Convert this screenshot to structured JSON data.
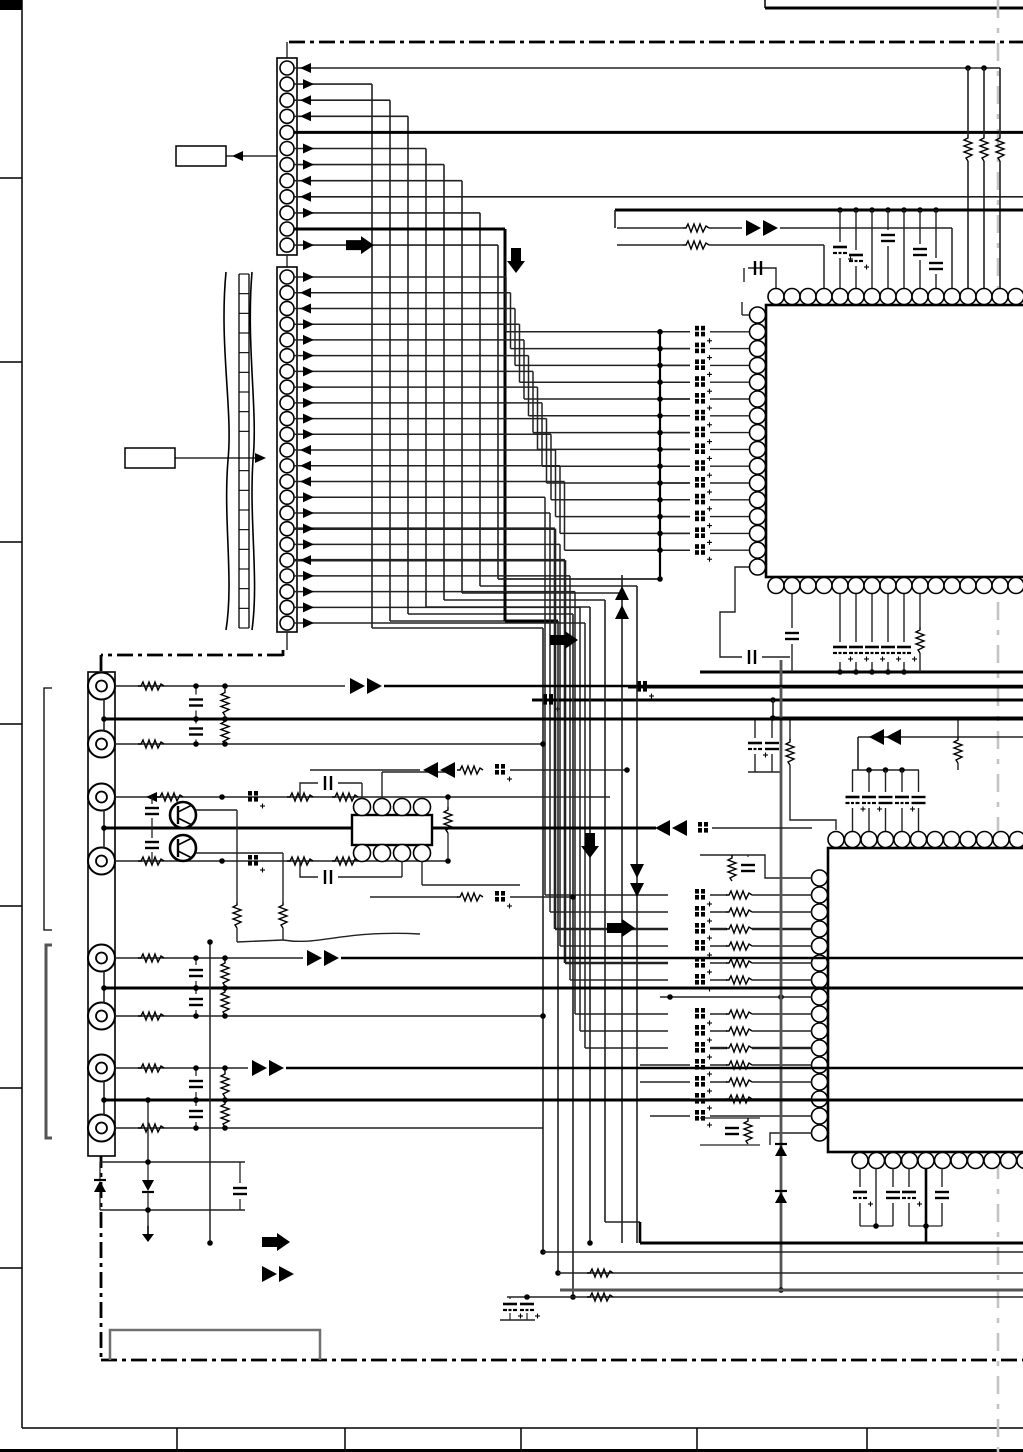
{
  "document": {
    "kind": "scanned-circuit-schematic",
    "title": "",
    "sheet_background": "#ffffff"
  },
  "palette": {
    "ink": "#000000",
    "wire": "#222222",
    "gray_wire": "#555555",
    "fold_line": "#c4c4c4",
    "notch_gray": "#707070"
  },
  "frame": {
    "ruler_segments": 8,
    "ruler_tick_ys": [
      178,
      362,
      542,
      724,
      906,
      1088,
      1268
    ],
    "title_block_cells": 6,
    "title_divider_xs": [
      177,
      345,
      521,
      697,
      867
    ]
  },
  "connectors": {
    "top_connector": {
      "pin_count": 12,
      "pin_directions": [
        "in",
        "out",
        "in",
        "in",
        "bus",
        "out",
        "out",
        "in",
        "in",
        "out",
        "bus",
        "out"
      ]
    },
    "flex_connector": {
      "pin_count": 23,
      "pin_directions": [
        "out",
        "in",
        "in",
        "out",
        "out",
        "out",
        "out",
        "out",
        "out",
        "out",
        "out",
        "in",
        "in",
        "in",
        "out",
        "out",
        "out",
        "out",
        "in",
        "out",
        "out",
        "out",
        "out"
      ]
    },
    "rca_jack_count": 8,
    "flex_ribbon_rungs": 18
  },
  "ics": {
    "ic1": {
      "top_pin_count": 16,
      "bottom_pin_count": 16,
      "left_pin_count": 16,
      "left_bead_rows": 14
    },
    "ic2": {
      "top_pin_count": 12,
      "left_pin_count": 16,
      "bottom_pin_count": 11
    },
    "small_ic": {
      "top_pin_count": 4,
      "bottom_pin_count": 4
    }
  },
  "labels": {
    "callout_top": "",
    "callout_flex": ""
  },
  "legend": {
    "block_arrow": "signal-direction",
    "double_triangle": "signal-path"
  }
}
